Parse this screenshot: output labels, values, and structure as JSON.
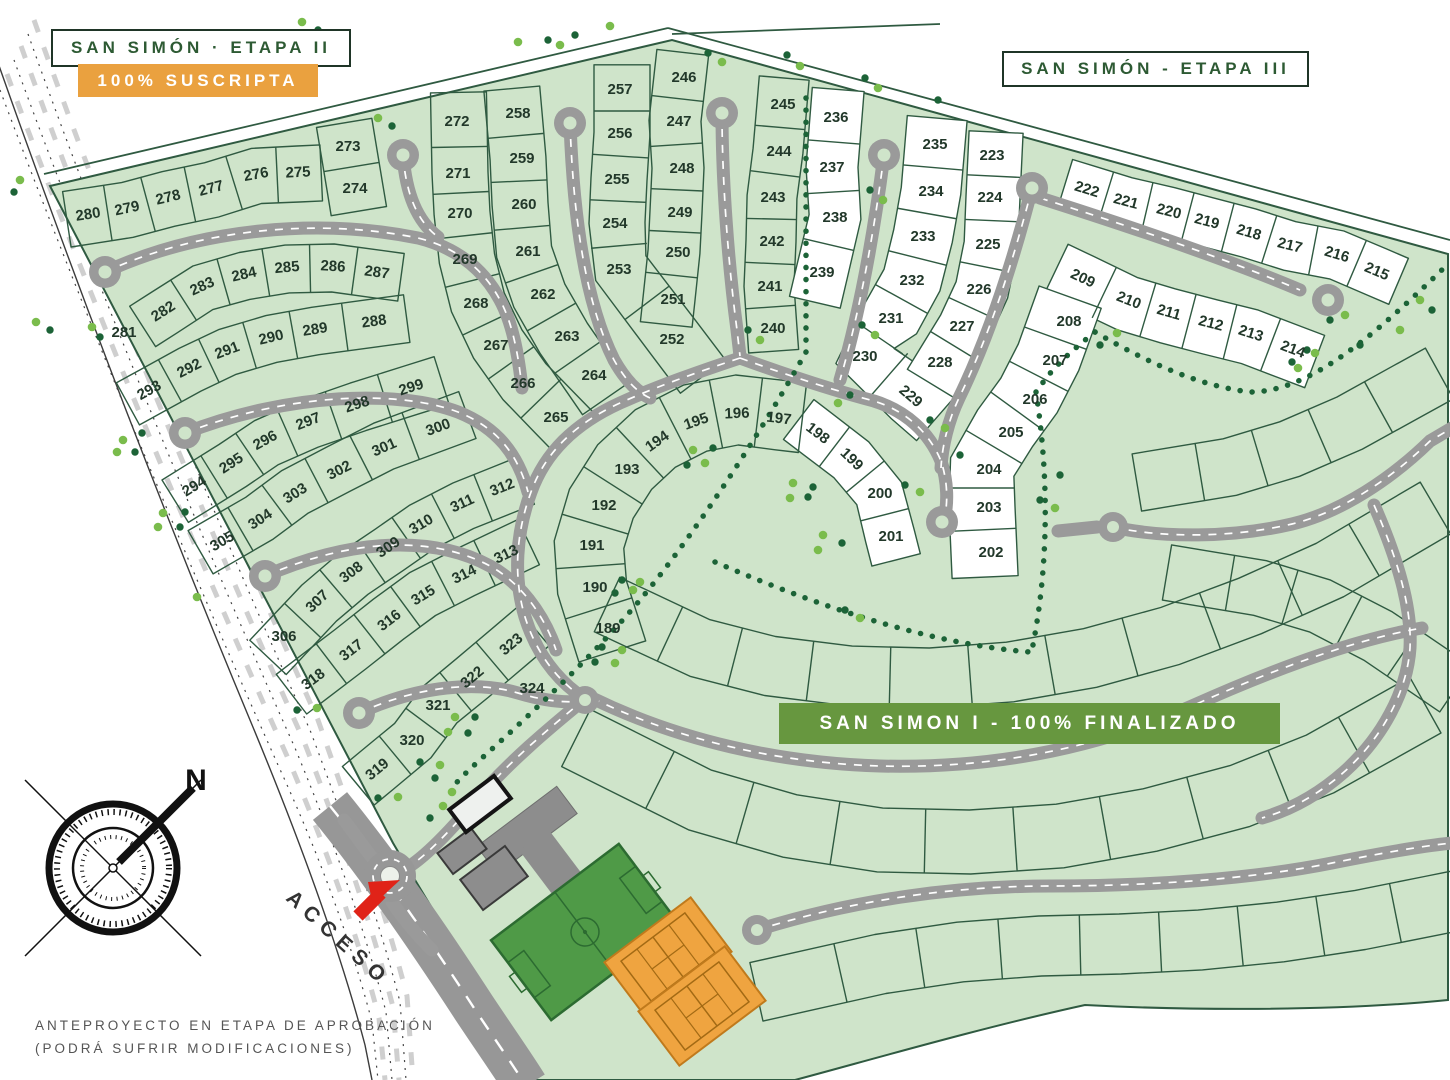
{
  "header": {
    "etapa2_title": "SAN SIMÓN · ETAPA II",
    "etapa2_status": "100% SUSCRIPTA",
    "etapa3_title": "SAN SIMÓN - ETAPA III"
  },
  "banner": {
    "san_simon_1": "SAN SIMON I -  100% FINALIZADO"
  },
  "labels": {
    "access": "ACCESO",
    "north": "N"
  },
  "footer": {
    "line1": "ANTEPROYECTO EN ETAPA DE APROBACIÓN",
    "line2": "(PODRÁ SUFRIR MODIFICACIONES)"
  },
  "colors": {
    "site_green": "#cfe4ca",
    "lot_white": "#ffffff",
    "line_green": "#2f5a41",
    "road_gray": "#9a9a9a",
    "banner_green": "#67973f",
    "status_orange": "#eaa13f",
    "title_green": "#2d5a33",
    "tree_light": "#7abc4c",
    "tree_dark": "#1c6337",
    "arrow_red": "#e02318",
    "label_ink": "#22382a"
  },
  "lots": [
    {
      "n": 189,
      "x": 608,
      "y": 628
    },
    {
      "n": 190,
      "x": 595,
      "y": 587
    },
    {
      "n": 191,
      "x": 592,
      "y": 545
    },
    {
      "n": 192,
      "x": 604,
      "y": 505
    },
    {
      "n": 193,
      "x": 627,
      "y": 469
    },
    {
      "n": 194,
      "x": 657,
      "y": 441
    },
    {
      "n": 195,
      "x": 696,
      "y": 421
    },
    {
      "n": 196,
      "x": 737,
      "y": 413
    },
    {
      "n": 197,
      "x": 779,
      "y": 418
    },
    {
      "n": 198,
      "x": 818,
      "y": 433
    },
    {
      "n": 199,
      "x": 852,
      "y": 459
    },
    {
      "n": 200,
      "x": 880,
      "y": 493
    },
    {
      "n": 201,
      "x": 891,
      "y": 536
    },
    {
      "n": 202,
      "x": 991,
      "y": 552
    },
    {
      "n": 203,
      "x": 989,
      "y": 507
    },
    {
      "n": 204,
      "x": 989,
      "y": 469
    },
    {
      "n": 205,
      "x": 1011,
      "y": 432
    },
    {
      "n": 206,
      "x": 1035,
      "y": 399
    },
    {
      "n": 207,
      "x": 1055,
      "y": 360
    },
    {
      "n": 208,
      "x": 1069,
      "y": 321
    },
    {
      "n": 209,
      "x": 1083,
      "y": 278
    },
    {
      "n": 210,
      "x": 1129,
      "y": 300
    },
    {
      "n": 211,
      "x": 1169,
      "y": 312
    },
    {
      "n": 212,
      "x": 1211,
      "y": 323
    },
    {
      "n": 213,
      "x": 1251,
      "y": 333
    },
    {
      "n": 214,
      "x": 1293,
      "y": 349
    },
    {
      "n": 215,
      "x": 1377,
      "y": 271
    },
    {
      "n": 216,
      "x": 1337,
      "y": 254
    },
    {
      "n": 217,
      "x": 1290,
      "y": 245
    },
    {
      "n": 218,
      "x": 1249,
      "y": 232
    },
    {
      "n": 219,
      "x": 1207,
      "y": 221
    },
    {
      "n": 220,
      "x": 1169,
      "y": 211
    },
    {
      "n": 221,
      "x": 1126,
      "y": 201
    },
    {
      "n": 222,
      "x": 1087,
      "y": 189
    },
    {
      "n": 223,
      "x": 992,
      "y": 155
    },
    {
      "n": 224,
      "x": 990,
      "y": 197
    },
    {
      "n": 225,
      "x": 988,
      "y": 244
    },
    {
      "n": 226,
      "x": 979,
      "y": 289
    },
    {
      "n": 227,
      "x": 962,
      "y": 326
    },
    {
      "n": 228,
      "x": 940,
      "y": 362
    },
    {
      "n": 229,
      "x": 911,
      "y": 396
    },
    {
      "n": 230,
      "x": 865,
      "y": 356
    },
    {
      "n": 231,
      "x": 891,
      "y": 318
    },
    {
      "n": 232,
      "x": 912,
      "y": 280
    },
    {
      "n": 233,
      "x": 923,
      "y": 236
    },
    {
      "n": 234,
      "x": 931,
      "y": 191
    },
    {
      "n": 235,
      "x": 935,
      "y": 144
    },
    {
      "n": 236,
      "x": 836,
      "y": 117
    },
    {
      "n": 237,
      "x": 832,
      "y": 167
    },
    {
      "n": 238,
      "x": 835,
      "y": 217
    },
    {
      "n": 239,
      "x": 822,
      "y": 272
    },
    {
      "n": 240,
      "x": 773,
      "y": 328
    },
    {
      "n": 241,
      "x": 770,
      "y": 286
    },
    {
      "n": 242,
      "x": 772,
      "y": 241
    },
    {
      "n": 243,
      "x": 773,
      "y": 197
    },
    {
      "n": 244,
      "x": 779,
      "y": 151
    },
    {
      "n": 245,
      "x": 783,
      "y": 104
    },
    {
      "n": 246,
      "x": 684,
      "y": 77
    },
    {
      "n": 247,
      "x": 679,
      "y": 121
    },
    {
      "n": 248,
      "x": 682,
      "y": 168
    },
    {
      "n": 249,
      "x": 680,
      "y": 212
    },
    {
      "n": 250,
      "x": 678,
      "y": 252
    },
    {
      "n": 251,
      "x": 673,
      "y": 299
    },
    {
      "n": 252,
      "x": 672,
      "y": 339
    },
    {
      "n": 253,
      "x": 619,
      "y": 269
    },
    {
      "n": 254,
      "x": 615,
      "y": 223
    },
    {
      "n": 255,
      "x": 617,
      "y": 179
    },
    {
      "n": 256,
      "x": 620,
      "y": 133
    },
    {
      "n": 257,
      "x": 620,
      "y": 89
    },
    {
      "n": 258,
      "x": 518,
      "y": 113
    },
    {
      "n": 259,
      "x": 522,
      "y": 158
    },
    {
      "n": 260,
      "x": 524,
      "y": 204
    },
    {
      "n": 261,
      "x": 528,
      "y": 251
    },
    {
      "n": 262,
      "x": 543,
      "y": 294
    },
    {
      "n": 263,
      "x": 567,
      "y": 336
    },
    {
      "n": 264,
      "x": 594,
      "y": 375
    },
    {
      "n": 265,
      "x": 556,
      "y": 417
    },
    {
      "n": 266,
      "x": 523,
      "y": 383
    },
    {
      "n": 267,
      "x": 496,
      "y": 345
    },
    {
      "n": 268,
      "x": 476,
      "y": 303
    },
    {
      "n": 269,
      "x": 465,
      "y": 259
    },
    {
      "n": 270,
      "x": 460,
      "y": 213
    },
    {
      "n": 271,
      "x": 458,
      "y": 173
    },
    {
      "n": 272,
      "x": 457,
      "y": 121
    },
    {
      "n": 273,
      "x": 348,
      "y": 146
    },
    {
      "n": 274,
      "x": 355,
      "y": 188
    },
    {
      "n": 275,
      "x": 298,
      "y": 172
    },
    {
      "n": 276,
      "x": 256,
      "y": 174
    },
    {
      "n": 277,
      "x": 211,
      "y": 188
    },
    {
      "n": 278,
      "x": 168,
      "y": 197
    },
    {
      "n": 279,
      "x": 127,
      "y": 208
    },
    {
      "n": 280,
      "x": 88,
      "y": 214
    },
    {
      "n": 281,
      "x": 124,
      "y": 332
    },
    {
      "n": 282,
      "x": 163,
      "y": 311
    },
    {
      "n": 283,
      "x": 202,
      "y": 286
    },
    {
      "n": 284,
      "x": 244,
      "y": 274
    },
    {
      "n": 285,
      "x": 287,
      "y": 267
    },
    {
      "n": 286,
      "x": 333,
      "y": 266
    },
    {
      "n": 287,
      "x": 377,
      "y": 272
    },
    {
      "n": 288,
      "x": 374,
      "y": 321
    },
    {
      "n": 289,
      "x": 315,
      "y": 329
    },
    {
      "n": 290,
      "x": 271,
      "y": 337
    },
    {
      "n": 291,
      "x": 227,
      "y": 350
    },
    {
      "n": 292,
      "x": 189,
      "y": 368
    },
    {
      "n": 293,
      "x": 149,
      "y": 390
    },
    {
      "n": 294,
      "x": 194,
      "y": 486
    },
    {
      "n": 295,
      "x": 231,
      "y": 463
    },
    {
      "n": 296,
      "x": 265,
      "y": 440
    },
    {
      "n": 297,
      "x": 308,
      "y": 421
    },
    {
      "n": 298,
      "x": 357,
      "y": 404
    },
    {
      "n": 299,
      "x": 411,
      "y": 387
    },
    {
      "n": 300,
      "x": 438,
      "y": 427
    },
    {
      "n": 301,
      "x": 384,
      "y": 447
    },
    {
      "n": 302,
      "x": 339,
      "y": 470
    },
    {
      "n": 303,
      "x": 295,
      "y": 493
    },
    {
      "n": 304,
      "x": 260,
      "y": 519
    },
    {
      "n": 305,
      "x": 222,
      "y": 541
    },
    {
      "n": 306,
      "x": 284,
      "y": 636
    },
    {
      "n": 307,
      "x": 317,
      "y": 601
    },
    {
      "n": 308,
      "x": 351,
      "y": 572
    },
    {
      "n": 309,
      "x": 388,
      "y": 547
    },
    {
      "n": 310,
      "x": 421,
      "y": 524
    },
    {
      "n": 311,
      "x": 462,
      "y": 503
    },
    {
      "n": 312,
      "x": 502,
      "y": 487
    },
    {
      "n": 313,
      "x": 506,
      "y": 554
    },
    {
      "n": 314,
      "x": 464,
      "y": 574
    },
    {
      "n": 315,
      "x": 423,
      "y": 595
    },
    {
      "n": 316,
      "x": 389,
      "y": 620
    },
    {
      "n": 317,
      "x": 351,
      "y": 650
    },
    {
      "n": 318,
      "x": 313,
      "y": 679
    },
    {
      "n": 319,
      "x": 377,
      "y": 769
    },
    {
      "n": 320,
      "x": 412,
      "y": 740
    },
    {
      "n": 321,
      "x": 438,
      "y": 705
    },
    {
      "n": 322,
      "x": 472,
      "y": 677
    },
    {
      "n": 323,
      "x": 511,
      "y": 644
    },
    {
      "n": 324,
      "x": 532,
      "y": 688
    }
  ],
  "fences": [
    {
      "lots": [
        280,
        279,
        278,
        277,
        276,
        275
      ],
      "t": 26,
      "b": 30
    },
    {
      "lots": [
        273,
        274
      ],
      "t": 28,
      "b": 28
    },
    {
      "lots": [
        282,
        283,
        284,
        285,
        286,
        287
      ],
      "t": 22,
      "b": 26
    },
    {
      "lots": [
        293,
        292,
        291,
        290,
        289,
        288
      ],
      "t": 22,
      "b": 26
    },
    {
      "lots": [
        294,
        295,
        296,
        297,
        298,
        299
      ],
      "t": 22,
      "b": 28
    },
    {
      "lots": [
        305,
        304,
        303,
        302,
        301,
        300
      ],
      "t": 26,
      "b": 24
    },
    {
      "lots": [
        306,
        307,
        308,
        309,
        310,
        311,
        312
      ],
      "t": 22,
      "b": 28
    },
    {
      "lots": [
        318,
        317,
        316,
        315,
        314,
        313
      ],
      "t": 26,
      "b": 24
    },
    {
      "lots": [
        319,
        320,
        321,
        322,
        323
      ],
      "t": 24,
      "b": 26
    },
    {
      "lots": [
        272,
        271,
        270,
        269,
        268,
        267,
        266,
        265
      ],
      "t": 30,
      "b": 26
    },
    {
      "lots": [
        258,
        259,
        260,
        261,
        262,
        263,
        264
      ],
      "t": 24,
      "b": 32
    },
    {
      "lots": [
        257,
        256,
        255,
        254,
        253,
        252
      ],
      "t": 30,
      "b": 26
    },
    {
      "lots": [
        246,
        247,
        248,
        249,
        250,
        251
      ],
      "t": 22,
      "b": 30
    },
    {
      "lots": [
        245,
        244,
        243,
        242,
        241,
        240
      ],
      "t": 24,
      "b": 26
    },
    {
      "lots": [
        236,
        237,
        238,
        239
      ],
      "t": 26,
      "b": 26,
      "fill": "#ffffff"
    },
    {
      "lots": [
        235,
        234,
        233,
        232,
        231,
        230,
        229
      ],
      "t": 30,
      "b": 30,
      "fill": "#ffffff"
    },
    {
      "lots": [
        223,
        224,
        225,
        226,
        227,
        228
      ],
      "t": 30,
      "b": 24,
      "fill": "#ffffff"
    },
    {
      "lots": [
        222,
        221,
        220,
        219,
        218,
        217,
        216,
        215
      ],
      "t": 24,
      "b": 26,
      "fill": "#ffffff"
    },
    {
      "lots": [
        209,
        210,
        211,
        212,
        213,
        214
      ],
      "t": 24,
      "b": 32,
      "fill": "#ffffff"
    },
    {
      "lots": [
        208,
        207,
        206,
        205,
        204,
        203,
        202
      ],
      "t": 26,
      "b": 40,
      "fill": "#ffffff"
    },
    {
      "lots": [
        198,
        199,
        200,
        201
      ],
      "t": 24,
      "b": 26,
      "fill": "#ffffff"
    },
    {
      "lots": [
        189,
        190,
        191,
        192,
        193,
        194,
        195,
        196,
        197
      ],
      "t": 38,
      "b": 32
    },
    {
      "pts": [
        [
          640,
          620
        ],
        [
          700,
          648
        ],
        [
          770,
          666
        ],
        [
          850,
          676
        ],
        [
          930,
          678
        ],
        [
          1010,
          672
        ],
        [
          1090,
          658
        ],
        [
          1170,
          636
        ],
        [
          1250,
          606
        ],
        [
          1330,
          570
        ],
        [
          1398,
          530
        ]
      ],
      "t": 30,
      "b": 30
    },
    {
      "pts": [
        [
          620,
          760
        ],
        [
          700,
          800
        ],
        [
          790,
          826
        ],
        [
          880,
          840
        ],
        [
          970,
          842
        ],
        [
          1060,
          836
        ],
        [
          1150,
          820
        ],
        [
          1240,
          796
        ],
        [
          1320,
          764
        ],
        [
          1388,
          726
        ]
      ],
      "t": 32,
      "b": 32
    },
    {
      "pts": [
        [
          800,
          980
        ],
        [
          880,
          962
        ],
        [
          960,
          950
        ],
        [
          1040,
          944
        ],
        [
          1120,
          942
        ],
        [
          1200,
          938
        ],
        [
          1280,
          930
        ],
        [
          1360,
          918
        ],
        [
          1430,
          904
        ]
      ],
      "t": 28,
      "b": 32
    },
    {
      "pts": [
        [
          1170,
          478
        ],
        [
          1230,
          468
        ],
        [
          1290,
          450
        ],
        [
          1350,
          424
        ],
        [
          1408,
          392
        ]
      ],
      "t": 30,
      "b": 28
    },
    {
      "pts": [
        [
          1200,
          578
        ],
        [
          1260,
          588
        ],
        [
          1320,
          606
        ],
        [
          1378,
          636
        ],
        [
          1428,
          670
        ]
      ],
      "t": 28,
      "b": 28
    }
  ],
  "dotlines": [
    "M 806,98 L 806,350",
    "M 806,352 C 768,420 700,528 640,600 C 600,648 540,706 482,758 C 470,769 460,778 452,788",
    "M 715,562 C 820,607 930,644 1030,652",
    "M 1036,392 C 1048,470 1050,560 1032,650",
    "M 1095,332 C 1150,364 1200,386 1250,392 C 1312,392 1380,330 1448,264",
    "M 1095,332 C 1070,352 1050,370 1038,390"
  ],
  "trees": [
    [
      302,
      22
    ],
    [
      318,
      30
    ],
    [
      378,
      118
    ],
    [
      392,
      126
    ],
    [
      518,
      42
    ],
    [
      548,
      40
    ],
    [
      610,
      26
    ],
    [
      708,
      53
    ],
    [
      722,
      62
    ],
    [
      787,
      55
    ],
    [
      800,
      66
    ],
    [
      865,
      78
    ],
    [
      878,
      88
    ],
    [
      938,
      100
    ],
    [
      20,
      180
    ],
    [
      14,
      192
    ],
    [
      36,
      322
    ],
    [
      50,
      330
    ],
    [
      92,
      327
    ],
    [
      100,
      337
    ],
    [
      123,
      440
    ],
    [
      142,
      433
    ],
    [
      117,
      452
    ],
    [
      135,
      452
    ],
    [
      163,
      513
    ],
    [
      185,
      512
    ],
    [
      158,
      527
    ],
    [
      180,
      527
    ],
    [
      197,
      597
    ],
    [
      297,
      710
    ],
    [
      317,
      708
    ],
    [
      378,
      798
    ],
    [
      398,
      797
    ],
    [
      420,
      762
    ],
    [
      440,
      765
    ],
    [
      435,
      778
    ],
    [
      455,
      717
    ],
    [
      475,
      717
    ],
    [
      448,
      732
    ],
    [
      468,
      733
    ],
    [
      693,
      450
    ],
    [
      713,
      448
    ],
    [
      705,
      463
    ],
    [
      687,
      465
    ],
    [
      793,
      483
    ],
    [
      813,
      487
    ],
    [
      790,
      498
    ],
    [
      808,
      497
    ],
    [
      823,
      535
    ],
    [
      842,
      543
    ],
    [
      818,
      550
    ],
    [
      622,
      580
    ],
    [
      640,
      582
    ],
    [
      615,
      593
    ],
    [
      633,
      590
    ],
    [
      602,
      647
    ],
    [
      622,
      650
    ],
    [
      595,
      662
    ],
    [
      615,
      663
    ],
    [
      862,
      325
    ],
    [
      875,
      335
    ],
    [
      850,
      395
    ],
    [
      838,
      403
    ],
    [
      1307,
      350
    ],
    [
      1315,
      353
    ],
    [
      1292,
      362
    ],
    [
      1298,
      368
    ],
    [
      1330,
      320
    ],
    [
      1345,
      315
    ],
    [
      1100,
      345
    ],
    [
      1117,
      333
    ],
    [
      870,
      190
    ],
    [
      883,
      200
    ],
    [
      905,
      485
    ],
    [
      920,
      492
    ],
    [
      845,
      610
    ],
    [
      860,
      618
    ],
    [
      1040,
      500
    ],
    [
      1055,
      508
    ],
    [
      1060,
      475
    ],
    [
      443,
      806
    ],
    [
      430,
      818
    ],
    [
      452,
      792
    ],
    [
      748,
      330
    ],
    [
      760,
      340
    ],
    [
      930,
      420
    ],
    [
      945,
      428
    ],
    [
      960,
      455
    ],
    [
      1420,
      300
    ],
    [
      1432,
      310
    ],
    [
      1400,
      330
    ],
    [
      1360,
      345
    ],
    [
      560,
      45
    ],
    [
      575,
      35
    ]
  ]
}
